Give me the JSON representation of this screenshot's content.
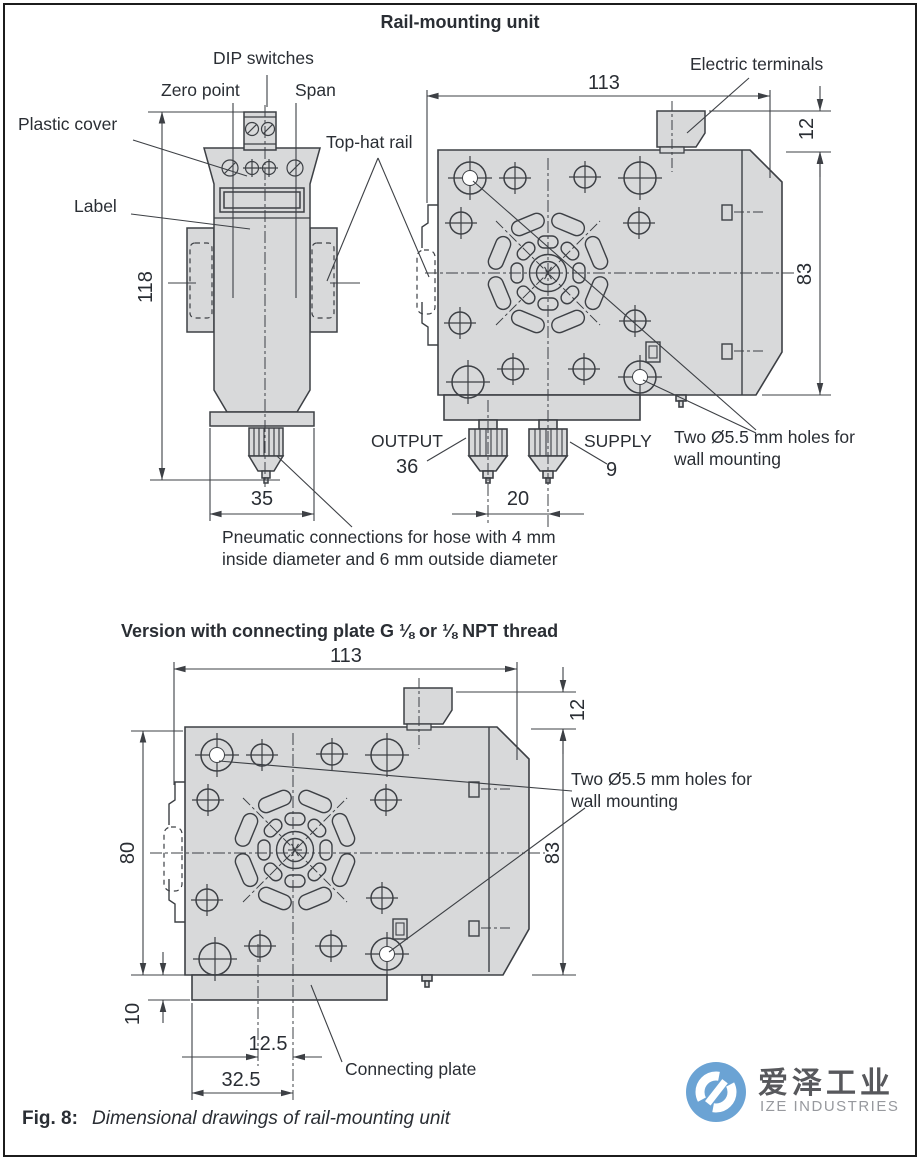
{
  "title": "Rail-mounting unit",
  "section1": {
    "labels": {
      "dip_switches": "DIP switches",
      "zero_point": "Zero point",
      "span": "Span",
      "plastic_cover": "Plastic cover",
      "label": "Label",
      "top_hat_rail": "Top-hat rail",
      "electric_terminals": "Electric terminals",
      "output": "OUTPUT",
      "output_port": "36",
      "supply": "SUPPLY",
      "supply_port": "9",
      "wall_holes": [
        "Two Ø5.5 mm holes for",
        "wall mounting"
      ],
      "pneumatic_note": [
        "Pneumatic connections for hose with 4 mm",
        "inside diameter and 6 mm outside diameter"
      ]
    },
    "dimensions": {
      "width": "113",
      "terminal_height": "12",
      "body_height": "83",
      "unit_height": "118",
      "unit_width": "35",
      "port_spacing": "20"
    }
  },
  "section2": {
    "title": "Version with connecting plate G ⅛ or ⅛ NPT thread",
    "labels": {
      "wall_holes": [
        "Two Ø5.5 mm holes for",
        "wall mounting"
      ],
      "connecting_plate": "Connecting plate"
    },
    "dimensions": {
      "width": "113",
      "terminal_height": "12",
      "body_height_right": "83",
      "body_height_left": "80",
      "plate_height": "10",
      "port_offset": "12.5",
      "plate_port_width": "32.5"
    }
  },
  "caption": {
    "fig_label": "Fig. 8:",
    "text": "Dimensional drawings of rail-mounting unit"
  },
  "logo": {
    "cn": "爱泽工业",
    "en": "IZE INDUSTRIES",
    "blue": "#6ba3d4"
  },
  "colors": {
    "fill": "#d8d9da",
    "line": "#3d4045",
    "text": "#2a2e34"
  }
}
